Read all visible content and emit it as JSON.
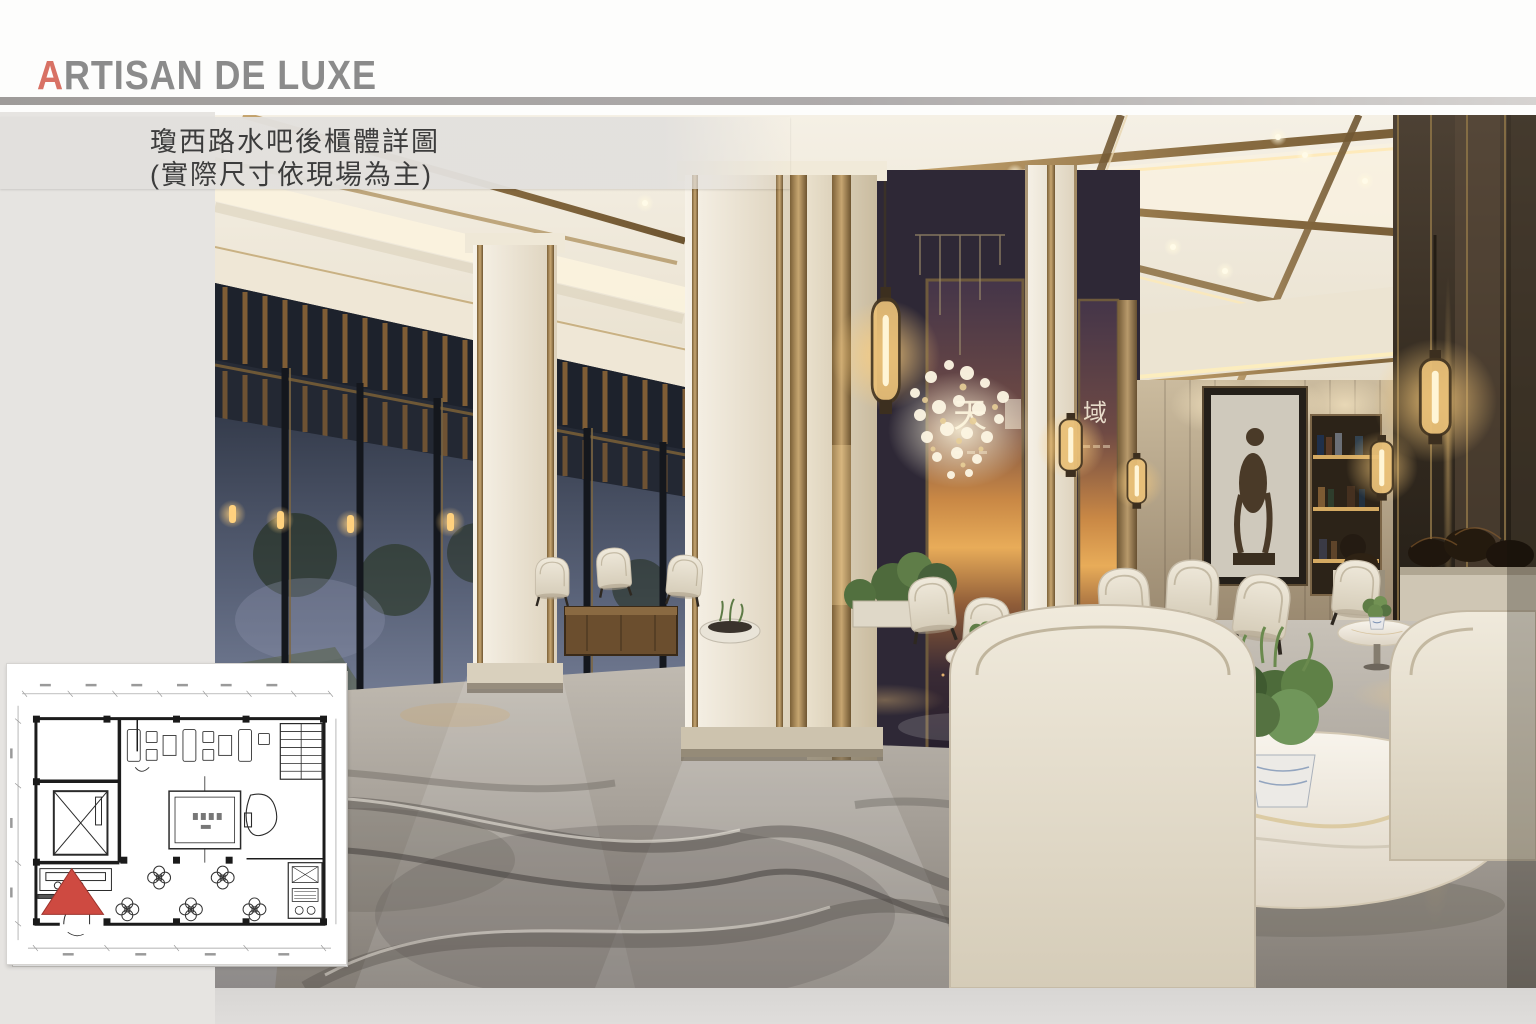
{
  "header": {
    "logo_first_letter": "A",
    "logo_rest": "RTISAN DE LUXE",
    "colors": {
      "initial": "#d87164",
      "rest": "#8b8b8b",
      "divider": "#a4a2a0",
      "background": "#fdfdfc"
    }
  },
  "title_block": {
    "line1": "瓊西路水吧後櫃體詳圖",
    "line2": "(實際尺寸依現場為主)",
    "text_color": "#3c3c3c",
    "band_color": "#e2e0dd"
  },
  "rendering": {
    "name": "lobby-interior-rendering",
    "mural_glyph_left": "天",
    "mural_glyph_right": "域",
    "palette": {
      "ceiling_cream": "#efe8d7",
      "brass_trim": "#a0835a",
      "window_dusk": "#59627a",
      "wood_lattice": "#8a6437",
      "column_marble": "#f3eee3",
      "mural_sunset": "#d3913f",
      "floor_marble": "#aaa59e",
      "chair_fabric": "#e9e3d4",
      "dark_bronze_wall": "#362d22",
      "lamp_glow": "#ffd98f"
    }
  },
  "floor_plan": {
    "name": "key-plan-inset",
    "paper_color": "#ffffff",
    "ink_color": "#2f2f2f",
    "marker_color": "#ce4a41"
  }
}
